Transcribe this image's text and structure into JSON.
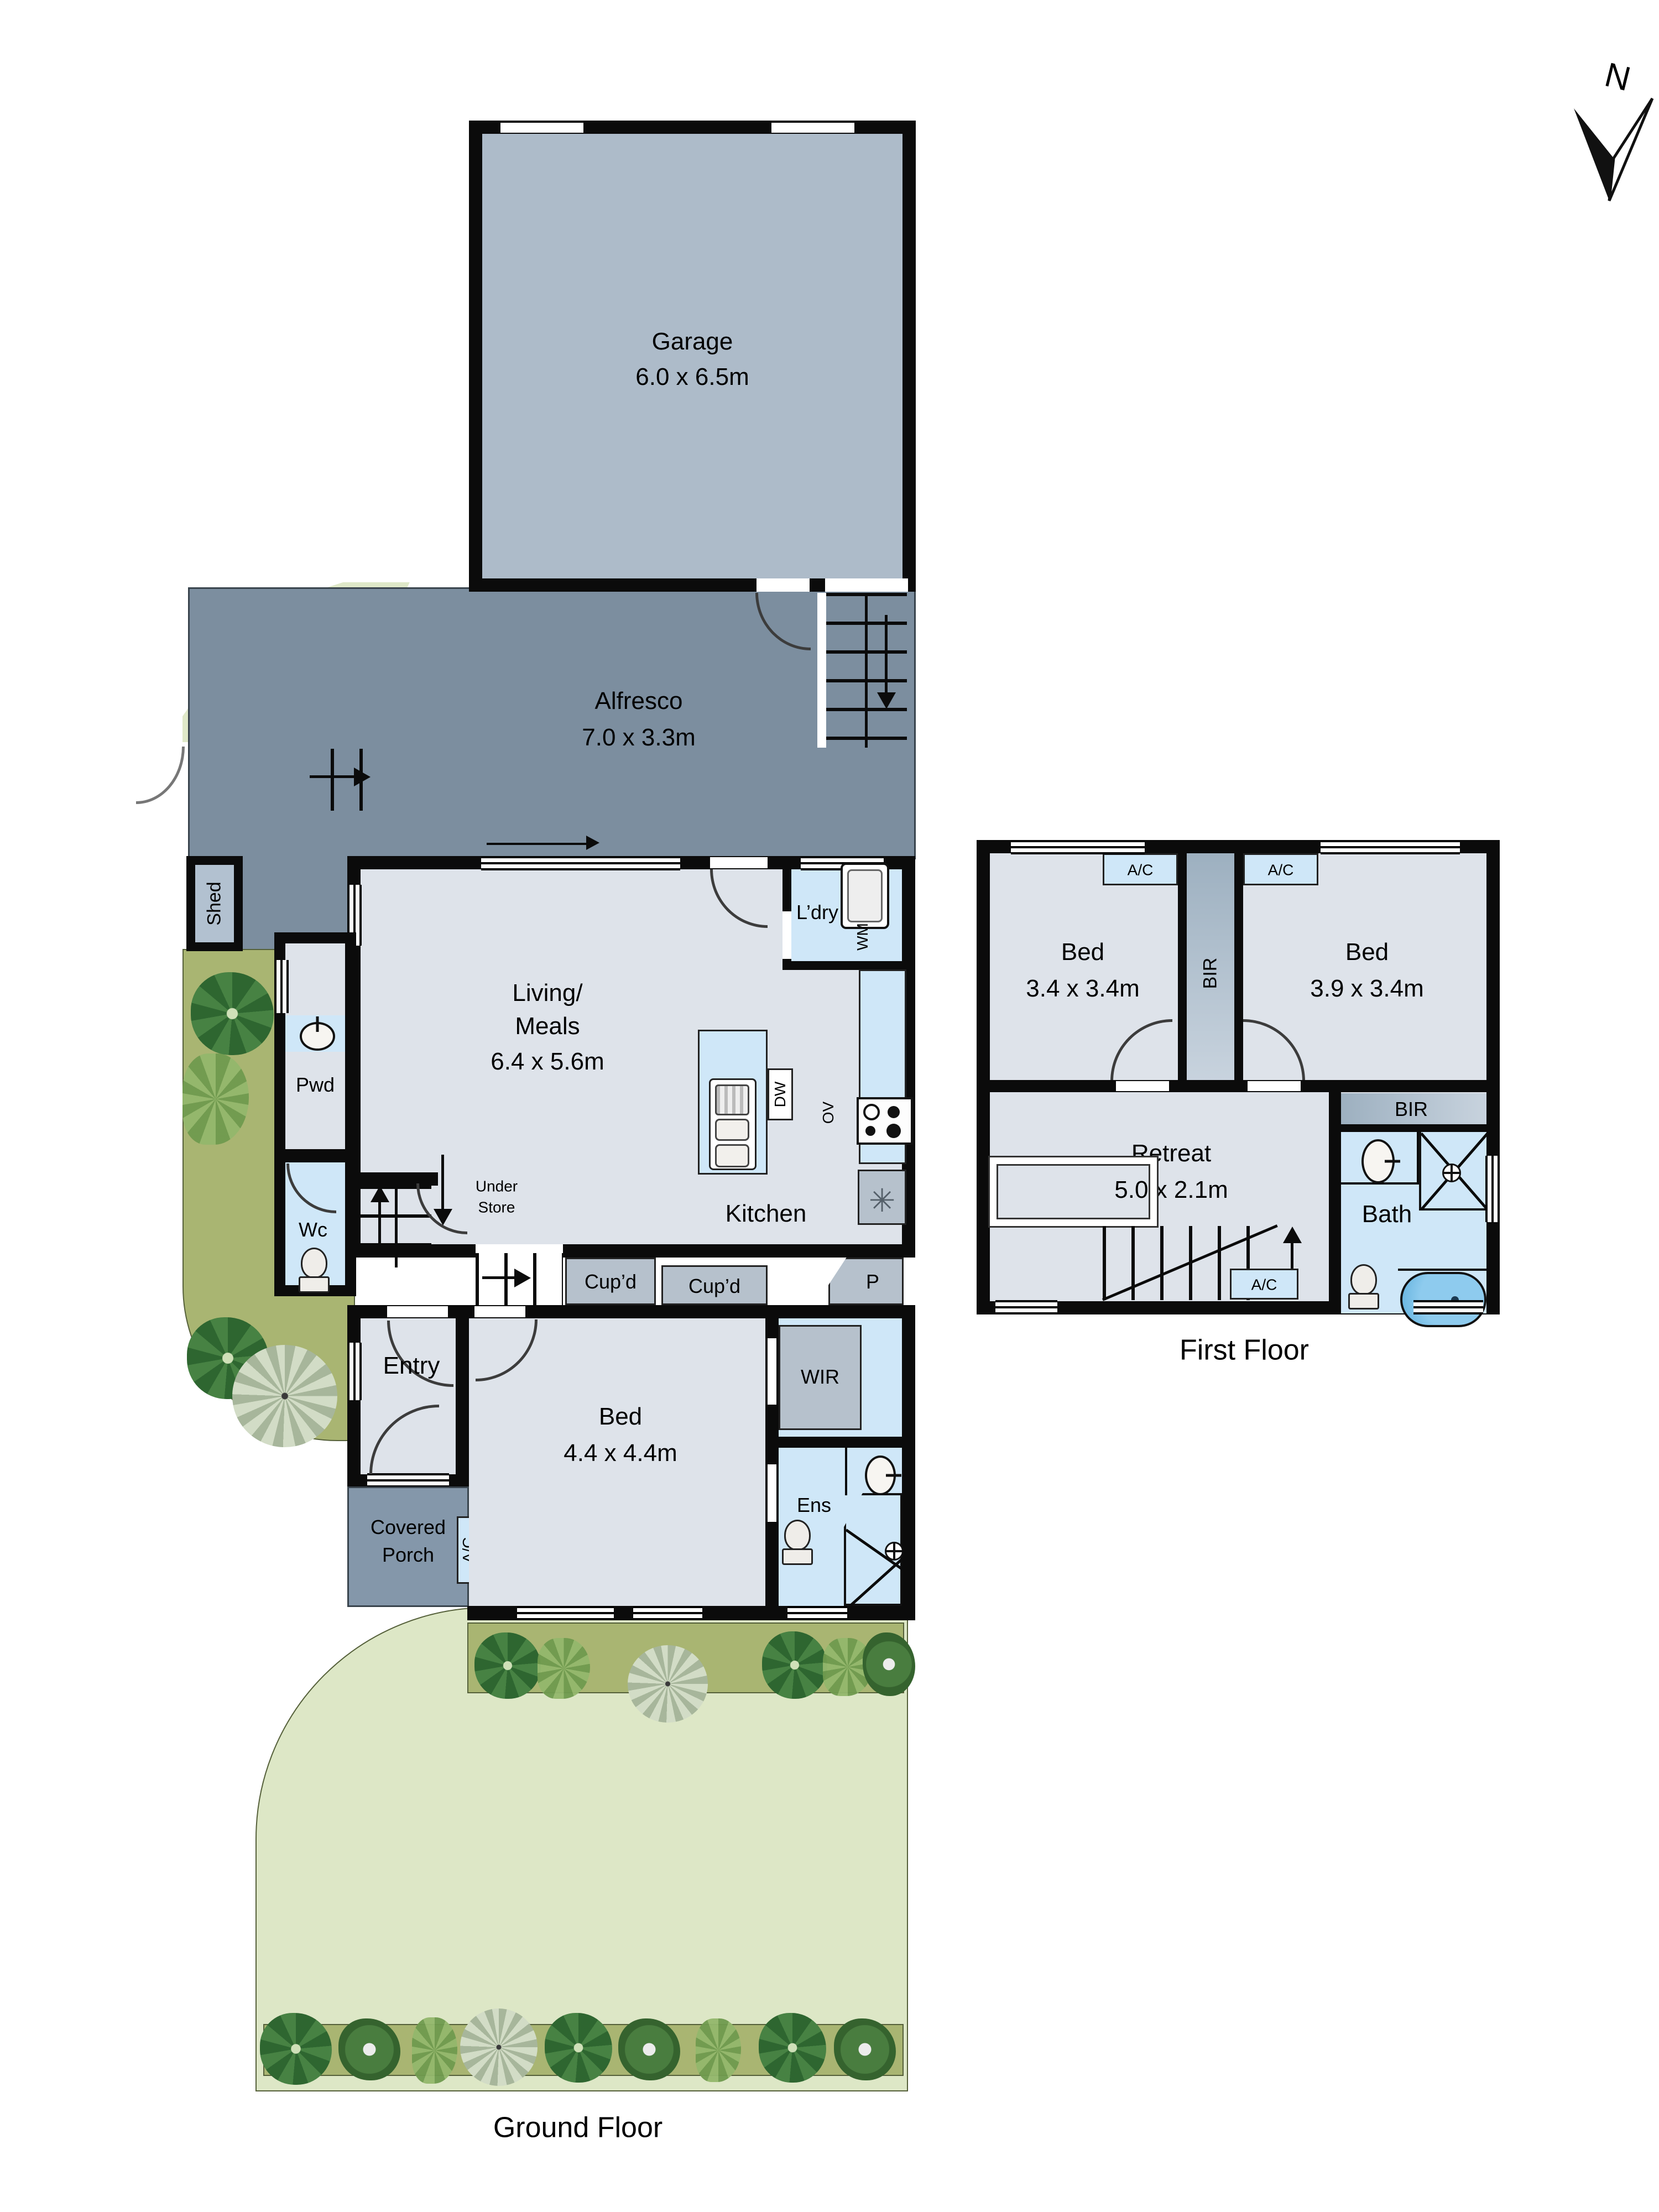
{
  "north": {
    "label": "N"
  },
  "captions": {
    "ground_floor": "Ground Floor",
    "first_floor": "First Floor"
  },
  "ground": {
    "garage": {
      "name": "Garage",
      "dims": "6.0 x 6.5m"
    },
    "alfresco": {
      "name": "Alfresco",
      "dims": "7.0 x 3.3m"
    },
    "shed": {
      "name": "Shed"
    },
    "living": {
      "line1": "Living/",
      "line2": "Meals",
      "dims": "6.4 x 5.6m"
    },
    "laundry": {
      "name": "L’dry",
      "washer": "WM"
    },
    "kitchen": {
      "name": "Kitchen",
      "dishwasher": "DW",
      "oven": "OV",
      "fridge_symbol": "✳"
    },
    "powder": {
      "name": "Pwd"
    },
    "wc": {
      "name": "Wc"
    },
    "under_store": {
      "line1": "Under",
      "line2": "Store"
    },
    "cupboard_left": {
      "name": "Cup’d"
    },
    "cupboard_mid": {
      "name": "Cup’d"
    },
    "pantry": {
      "name": "P"
    },
    "entry": {
      "name": "Entry"
    },
    "bed": {
      "name": "Bed",
      "dims": "4.4 x 4.4m"
    },
    "wir": {
      "name": "WIR"
    },
    "ens": {
      "name": "Ens"
    },
    "porch": {
      "line1": "Covered",
      "line2": "Porch"
    },
    "ac": {
      "name": "A/C"
    }
  },
  "first": {
    "bed_left": {
      "name": "Bed",
      "dims": "3.4 x 3.4m",
      "ac": "A/C"
    },
    "bed_right": {
      "name": "Bed",
      "dims": "3.9 x 3.4m",
      "ac": "A/C"
    },
    "bir_between": {
      "name": "BIR"
    },
    "bir_bath": {
      "name": "BIR"
    },
    "retreat": {
      "name": "Retreat",
      "dims": "5.0 x 2.1m"
    },
    "bath": {
      "name": "Bath"
    },
    "stair_ac": {
      "name": "A/C"
    }
  },
  "colors": {
    "wall": "#0b0b0b",
    "room": "#dee3ea",
    "wet_blue": "#cfe7f8",
    "paving": "#7c8e9f",
    "garage": "#adbbc9",
    "shed": "#b2c1d0",
    "fixture_gray": "#b6c1cc",
    "lawn": "#dde7c6",
    "garden_olive": "#a9b572",
    "tub_blue": "#7fc4e8"
  }
}
